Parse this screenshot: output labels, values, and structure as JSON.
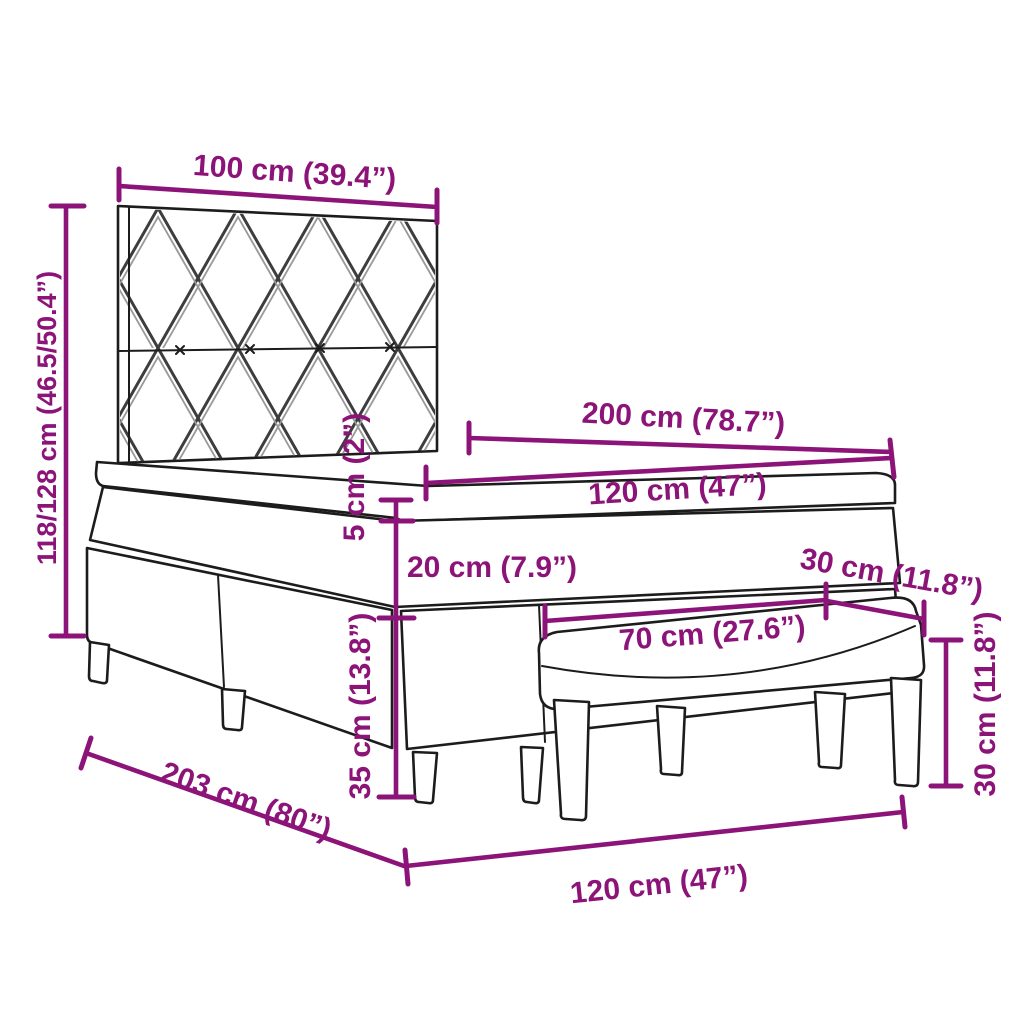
{
  "title": "Box spring bed with headboard and bench – dimension diagram",
  "colors": {
    "dimension_accent": "#8C1479",
    "line_art": "#1c1c1c",
    "background": "#ffffff"
  },
  "drawing": {
    "parts": [
      "headboard with diamond pattern",
      "mattress topper",
      "mattress",
      "box spring base",
      "bench"
    ]
  },
  "labels": {
    "headboard_width": "100 cm (39.4”)",
    "headboard_height": "118/128 cm (46.5/50.4”)",
    "bed_length": "200 cm (78.7”)",
    "bed_width": "120 cm (47”)",
    "topper_height": "5 cm (2”)",
    "mattress_height": "20 cm (7.9”)",
    "base_height": "35 cm (13.8”)",
    "bench_depth": "30 cm (11.8”)",
    "bench_length": "70 cm (27.6”)",
    "bench_height": "30 cm (11.8”)",
    "total_length": "203 cm (80”)",
    "footprint_width": "120 cm (47”)"
  }
}
